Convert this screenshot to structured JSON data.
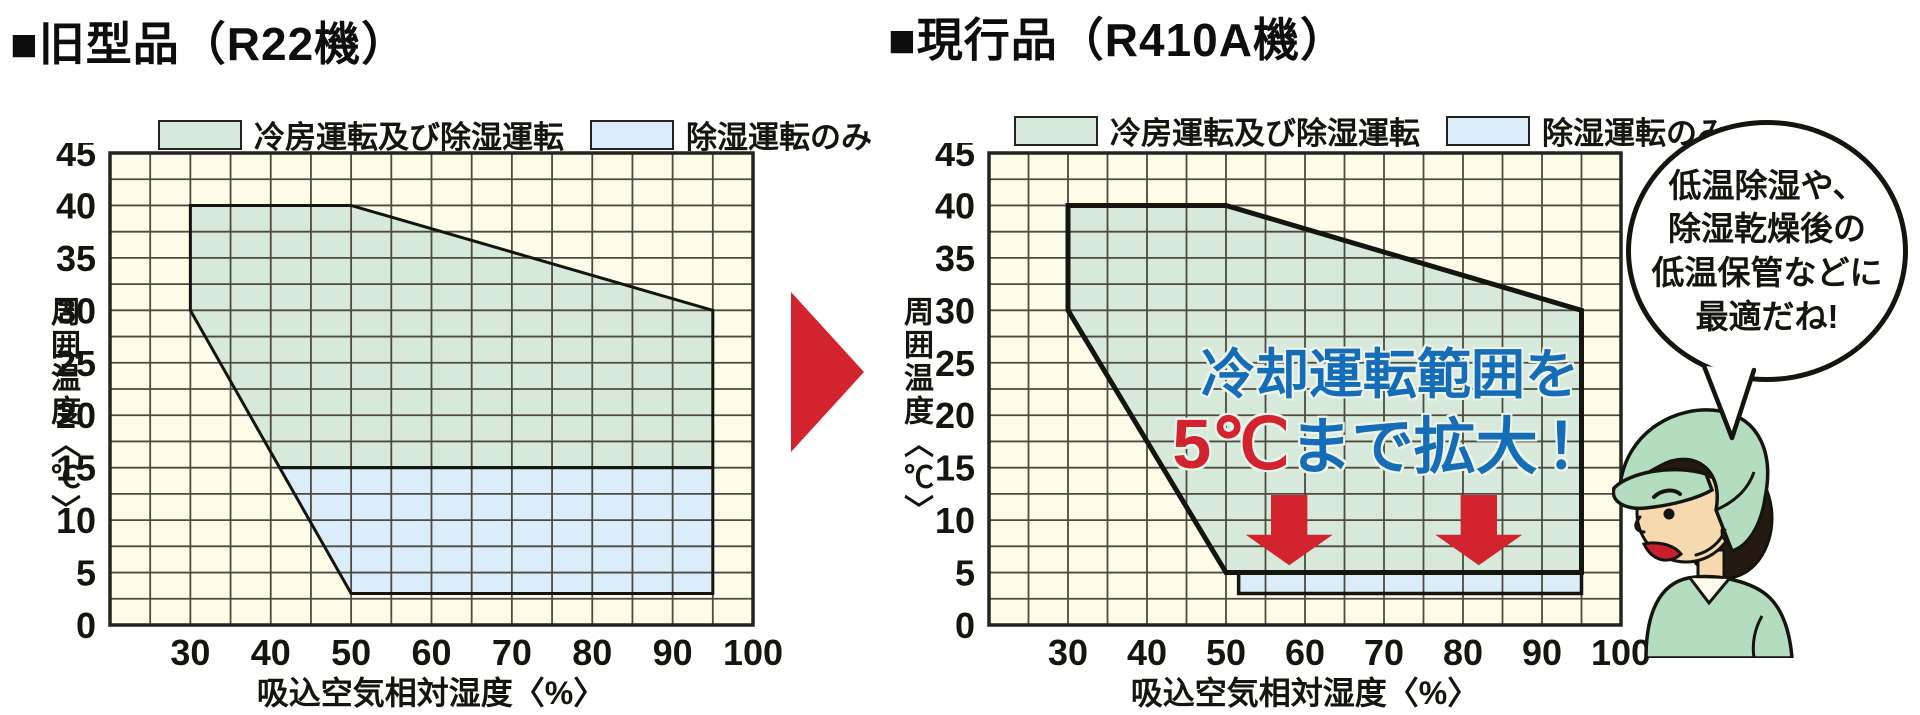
{
  "titles": {
    "left": "■旧型品（R22機）",
    "right": "■現行品（R410A機）"
  },
  "legend": {
    "items": [
      {
        "label": "冷房運転及び除湿運転",
        "color": "#d7e9da"
      },
      {
        "label": "除湿運転のみ",
        "color": "#daedf8"
      }
    ]
  },
  "axes": {
    "x_title": "吸込空気相対湿度〈%〉",
    "y_title": "周囲温度〈℃〉"
  },
  "overlay": {
    "line1": "冷却運転範囲を",
    "line2_red": "5℃",
    "line2_blue": "まで拡大",
    "line2_excl": "！"
  },
  "bubble": {
    "lines": [
      "低温除湿や、",
      "除湿乾燥後の",
      "低温保管などに",
      "最適だね!"
    ]
  },
  "colors": {
    "plot_bg": "#fdfce9",
    "region_green": "#d7e9da",
    "region_blue": "#daedf8",
    "grid": "#4c4b41",
    "frame": "#24241e",
    "region_border": "#15150f",
    "red": "#d2232e",
    "text_blue": "#156db8",
    "text_black": "#15150f"
  },
  "chart_data": [
    {
      "type": "area",
      "title": "旧型品（R22機）",
      "xlabel": "吸込空気相対湿度〈%〉",
      "ylabel": "周囲温度〈℃〉",
      "xlim": [
        20,
        100
      ],
      "ylim": [
        0,
        45
      ],
      "x_ticks": [
        30,
        40,
        50,
        60,
        70,
        80,
        90,
        100
      ],
      "y_ticks": [
        0,
        5,
        10,
        15,
        20,
        25,
        30,
        35,
        40,
        45
      ],
      "x_grid_step": 5,
      "y_grid_step": 2.5,
      "grid": true,
      "legend_position": "top",
      "series": [
        {
          "name": "冷房運転及び除湿運転",
          "role": "cooling_and_dehumidify",
          "color": "#d7e9da",
          "border_width": 3,
          "points": [
            [
              30,
              30
            ],
            [
              30,
              40
            ],
            [
              50,
              40
            ],
            [
              95,
              30
            ],
            [
              95,
              15
            ],
            [
              41.1,
              15
            ]
          ]
        },
        {
          "name": "除湿運転のみ",
          "role": "dehumidify_only",
          "color": "#daedf8",
          "border_width": 3,
          "points": [
            [
              41.1,
              15
            ],
            [
              95,
              15
            ],
            [
              95,
              3
            ],
            [
              50,
              3
            ]
          ]
        }
      ]
    },
    {
      "type": "area",
      "title": "現行品（R410A機）",
      "xlabel": "吸込空気相対湿度〈%〉",
      "ylabel": "周囲温度〈℃〉",
      "xlim": [
        20,
        100
      ],
      "ylim": [
        0,
        45
      ],
      "x_ticks": [
        30,
        40,
        50,
        60,
        70,
        80,
        90,
        100
      ],
      "y_ticks": [
        0,
        5,
        10,
        15,
        20,
        25,
        30,
        35,
        40,
        45
      ],
      "x_grid_step": 5,
      "y_grid_step": 2.5,
      "grid": true,
      "legend_position": "top",
      "annotation": "冷却運転範囲を5℃まで拡大！",
      "series": [
        {
          "name": "冷房運転及び除湿運転",
          "role": "cooling_and_dehumidify",
          "color": "#d7e9da",
          "border_width": 5,
          "points": [
            [
              30,
              30
            ],
            [
              30,
              40
            ],
            [
              50,
              40
            ],
            [
              95,
              30
            ],
            [
              95,
              5
            ],
            [
              50,
              5
            ]
          ]
        },
        {
          "name": "除湿運転のみ",
          "role": "dehumidify_only",
          "color": "#daedf8",
          "border_width": 3.5,
          "points": [
            [
              51.6,
              5
            ],
            [
              95,
              5
            ],
            [
              95,
              3
            ],
            [
              51.6,
              3
            ]
          ]
        }
      ],
      "arrows_down": [
        {
          "x": 58,
          "y_top": 12.4,
          "y_neck": 8.6,
          "y_tip": 5.7,
          "stem_w": 4.6,
          "head_w": 11
        },
        {
          "x": 82,
          "y_top": 12.4,
          "y_neck": 8.6,
          "y_tip": 5.7,
          "stem_w": 4.6,
          "head_w": 11
        }
      ]
    }
  ]
}
